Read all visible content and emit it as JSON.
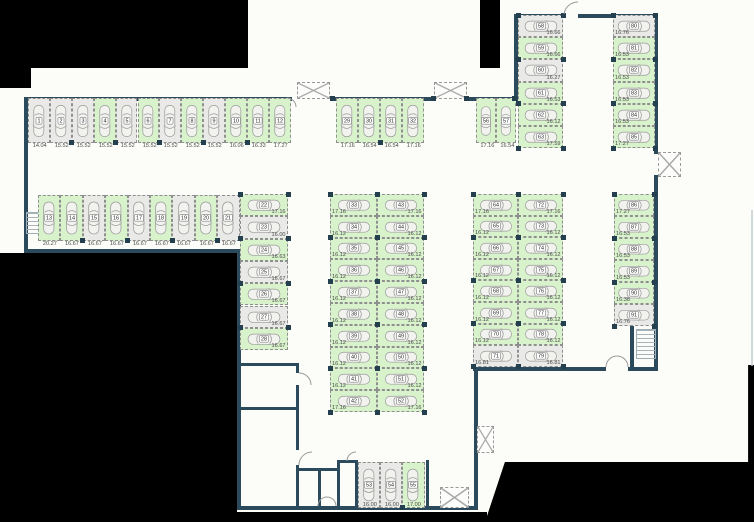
{
  "colors": {
    "available_fill": "#d8f3cb",
    "occupied_fill": "#e9e9e7",
    "wall": "#2b4a5b",
    "outside": "#000000",
    "stall_border": "#8f8f8f"
  },
  "groups": [
    {
      "id": "stalls-1-12",
      "stalls": [
        {
          "n": 1,
          "m": "14.04",
          "free": false
        },
        {
          "n": 2,
          "m": "15.52",
          "free": false
        },
        {
          "n": 3,
          "m": "15.52",
          "free": false
        },
        {
          "n": 4,
          "m": "15.52",
          "free": true
        },
        {
          "n": 5,
          "m": "15.52",
          "free": false
        },
        {
          "n": 6,
          "m": "15.52",
          "free": true
        },
        {
          "n": 7,
          "m": "15.52",
          "free": false
        },
        {
          "n": 8,
          "m": "15.52",
          "free": true
        },
        {
          "n": 9,
          "m": "15.52",
          "free": false
        },
        {
          "n": 10,
          "m": "16.06",
          "free": true
        },
        {
          "n": 11,
          "m": "16.33",
          "free": true
        },
        {
          "n": 12,
          "m": "17.27",
          "free": true
        }
      ]
    },
    {
      "id": "stalls-13-21",
      "stalls": [
        {
          "n": 13,
          "m": "20.27",
          "free": true
        },
        {
          "n": 14,
          "m": "16.67",
          "free": true
        },
        {
          "n": 15,
          "m": "16.67",
          "free": false
        },
        {
          "n": 16,
          "m": "16.67",
          "free": true
        },
        {
          "n": 17,
          "m": "16.67",
          "free": false
        },
        {
          "n": 18,
          "m": "16.67",
          "free": true
        },
        {
          "n": 19,
          "m": "16.67",
          "free": false
        },
        {
          "n": 20,
          "m": "16.67",
          "free": true
        },
        {
          "n": 21,
          "m": "16.67",
          "free": false
        }
      ]
    },
    {
      "id": "stalls-22-28",
      "stalls": [
        {
          "n": 22,
          "m": "17.16",
          "free": true
        },
        {
          "n": 23,
          "m": "16.00",
          "free": false
        },
        {
          "n": 24,
          "m": "16.63",
          "free": true
        },
        {
          "n": 25,
          "m": "16.67",
          "free": false
        },
        {
          "n": 26,
          "m": "16.67",
          "free": true
        },
        {
          "n": 27,
          "m": "16.67",
          "free": false
        },
        {
          "n": 28,
          "m": "16.67",
          "free": true
        }
      ]
    },
    {
      "id": "stalls-29-32",
      "stalls": [
        {
          "n": 29,
          "m": "17.16",
          "free": true
        },
        {
          "n": 30,
          "m": "16.54",
          "free": true
        },
        {
          "n": 31,
          "m": "16.54",
          "free": true
        },
        {
          "n": 32,
          "m": "17.16",
          "free": true
        }
      ]
    },
    {
      "id": "stalls-33-42",
      "stalls": [
        {
          "n": 33,
          "m": "17.16",
          "free": true
        },
        {
          "n": 34,
          "m": "16.12",
          "free": true
        },
        {
          "n": 35,
          "m": "16.12",
          "free": true
        },
        {
          "n": 36,
          "m": "16.12",
          "free": true
        },
        {
          "n": 37,
          "m": "16.12",
          "free": true
        },
        {
          "n": 38,
          "m": "16.12",
          "free": true
        },
        {
          "n": 39,
          "m": "16.12",
          "free": true
        },
        {
          "n": 40,
          "m": "16.12",
          "free": true
        },
        {
          "n": 41,
          "m": "16.12",
          "free": true
        },
        {
          "n": 42,
          "m": "17.16",
          "free": true
        }
      ]
    },
    {
      "id": "stalls-43-52",
      "stalls": [
        {
          "n": 43,
          "m": "17.16",
          "free": true
        },
        {
          "n": 44,
          "m": "16.12",
          "free": true
        },
        {
          "n": 45,
          "m": "16.12",
          "free": true
        },
        {
          "n": 46,
          "m": "16.12",
          "free": true
        },
        {
          "n": 47,
          "m": "16.12",
          "free": true
        },
        {
          "n": 48,
          "m": "16.12",
          "free": true
        },
        {
          "n": 49,
          "m": "16.12",
          "free": true
        },
        {
          "n": 50,
          "m": "16.12",
          "free": true
        },
        {
          "n": 51,
          "m": "16.12",
          "free": true
        },
        {
          "n": 52,
          "m": "17.16",
          "free": true
        }
      ]
    },
    {
      "id": "stalls-53-55",
      "stalls": [
        {
          "n": 53,
          "m": "16.00",
          "free": false
        },
        {
          "n": 54,
          "m": "16.00",
          "free": false
        },
        {
          "n": 55,
          "m": "17.00",
          "free": true
        }
      ]
    },
    {
      "id": "stalls-56-57",
      "stalls": [
        {
          "n": 56,
          "m": "17.16",
          "free": true
        },
        {
          "n": 57,
          "m": "16.54",
          "free": true
        }
      ]
    },
    {
      "id": "stalls-58-63",
      "stalls": [
        {
          "n": 58,
          "m": "16.66",
          "free": false
        },
        {
          "n": 59,
          "m": "16.66",
          "free": true
        },
        {
          "n": 60,
          "m": "16.27",
          "free": false
        },
        {
          "n": 61,
          "m": "16.53",
          "free": true
        },
        {
          "n": 62,
          "m": "16.12",
          "free": true
        },
        {
          "n": 63,
          "m": "17.59",
          "free": true
        }
      ]
    },
    {
      "id": "stalls-64-71",
      "stalls": [
        {
          "n": 64,
          "m": "17.16",
          "free": true
        },
        {
          "n": 65,
          "m": "16.12",
          "free": true
        },
        {
          "n": 66,
          "m": "16.12",
          "free": true
        },
        {
          "n": 67,
          "m": "16.12",
          "free": true
        },
        {
          "n": 68,
          "m": "16.12",
          "free": true
        },
        {
          "n": 69,
          "m": "16.12",
          "free": true
        },
        {
          "n": 70,
          "m": "16.12",
          "free": true
        },
        {
          "n": 71,
          "m": "16.81",
          "free": false
        }
      ]
    },
    {
      "id": "stalls-72-79",
      "stalls": [
        {
          "n": 72,
          "m": "17.16",
          "free": true
        },
        {
          "n": 73,
          "m": "16.12",
          "free": true
        },
        {
          "n": 74,
          "m": "16.12",
          "free": true
        },
        {
          "n": 75,
          "m": "16.12",
          "free": true
        },
        {
          "n": 76,
          "m": "16.12",
          "free": true
        },
        {
          "n": 77,
          "m": "16.12",
          "free": true
        },
        {
          "n": 78,
          "m": "16.12",
          "free": true
        },
        {
          "n": 79,
          "m": "16.81",
          "free": false
        }
      ]
    },
    {
      "id": "stalls-80-85",
      "stalls": [
        {
          "n": 80,
          "m": "16.76",
          "free": false
        },
        {
          "n": 81,
          "m": "16.53",
          "free": true
        },
        {
          "n": 82,
          "m": "16.53",
          "free": true
        },
        {
          "n": 83,
          "m": "16.53",
          "free": true
        },
        {
          "n": 84,
          "m": "16.53",
          "free": true
        },
        {
          "n": 85,
          "m": "17.27",
          "free": true
        }
      ]
    },
    {
      "id": "stalls-86-91",
      "stalls": [
        {
          "n": 86,
          "m": "17.27",
          "free": true
        },
        {
          "n": 87,
          "m": "16.53",
          "free": true
        },
        {
          "n": 88,
          "m": "16.53",
          "free": true
        },
        {
          "n": 89,
          "m": "16.53",
          "free": true
        },
        {
          "n": 90,
          "m": "16.38",
          "free": true
        },
        {
          "n": 91,
          "m": "16.76",
          "free": false
        }
      ]
    }
  ]
}
